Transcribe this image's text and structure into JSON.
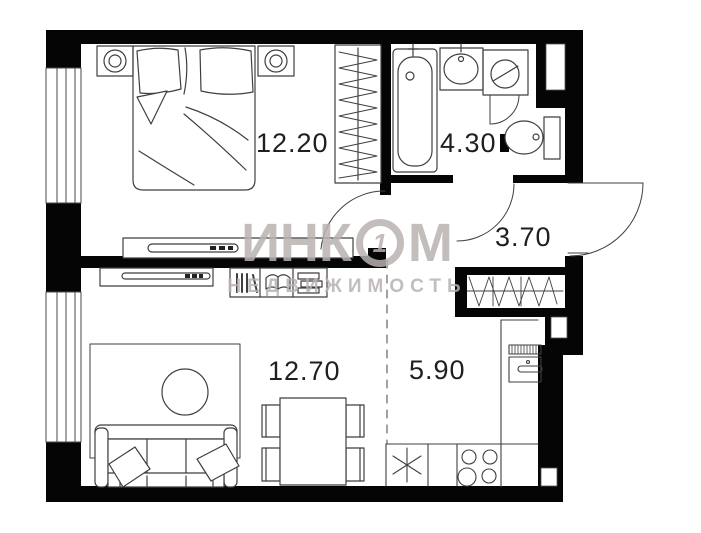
{
  "plan": {
    "title": "apartment-floor-plan",
    "rooms": [
      {
        "name": "bedroom",
        "area": "12.20"
      },
      {
        "name": "bathroom",
        "area": "4.30"
      },
      {
        "name": "hallway",
        "area": "3.70"
      },
      {
        "name": "living-room",
        "area": "12.70"
      },
      {
        "name": "kitchen",
        "area": "5.90"
      }
    ],
    "watermark": {
      "brand_left": "ИНК",
      "brand_o": "1",
      "brand_right": "М",
      "subtitle": "НЕДВИЖИМОСТЬ"
    },
    "colors": {
      "walls": "#000000",
      "furniture_lines": "#3f3f3f",
      "background": "#ffffff",
      "labels": "#1f1f1f",
      "watermark": "rgba(185,178,176,0.85)"
    }
  }
}
